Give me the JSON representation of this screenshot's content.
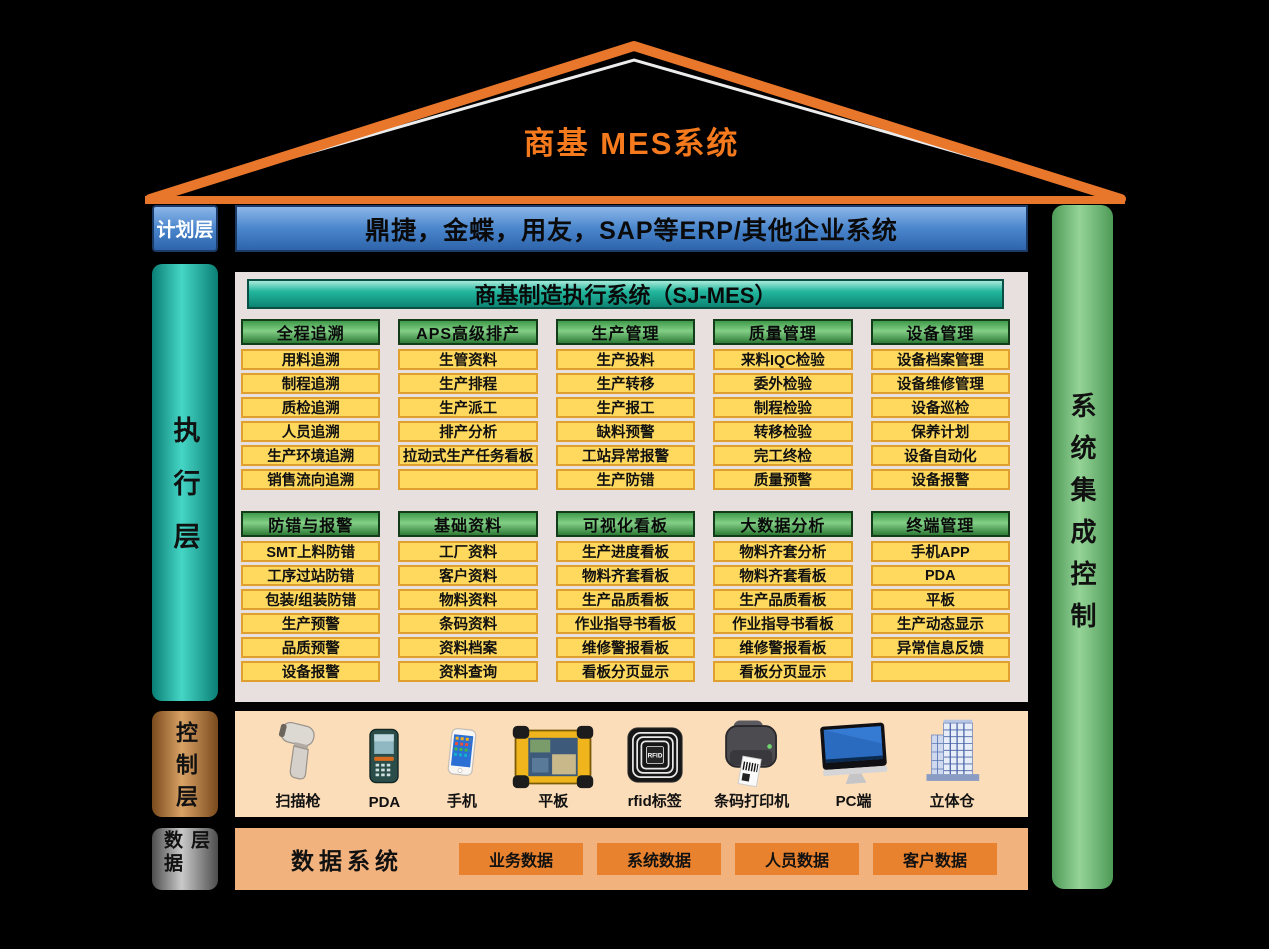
{
  "title": "商基  MES系统",
  "erp_bar": {
    "text": "鼎捷，金蝶，用友，SAP等ERP/其他企业系统"
  },
  "right_bar": {
    "label": "系统集成控制"
  },
  "layers": {
    "plan": {
      "label": "计划层"
    },
    "execute": {
      "label": "执行层"
    },
    "control": {
      "label": "控制层"
    },
    "data": {
      "label": "数据层"
    }
  },
  "mes_panel": {
    "header": "商基制造执行系统（SJ-MES）",
    "row1": [
      {
        "header": "全程追溯",
        "items": [
          "用料追溯",
          "制程追溯",
          "质检追溯",
          "人员追溯",
          "生产环境追溯",
          "销售流向追溯"
        ]
      },
      {
        "header": "APS高级排产",
        "items": [
          "生管资料",
          "生产排程",
          "生产派工",
          "排产分析",
          "拉动式生产任务看板",
          ""
        ]
      },
      {
        "header": "生产管理",
        "items": [
          "生产投料",
          "生产转移",
          "生产报工",
          "缺料预警",
          "工站异常报警",
          "生产防错"
        ]
      },
      {
        "header": "质量管理",
        "items": [
          "来料IQC检验",
          "委外检验",
          "制程检验",
          "转移检验",
          "完工终检",
          "质量预警"
        ]
      },
      {
        "header": "设备管理",
        "items": [
          "设备档案管理",
          "设备维修管理",
          "设备巡检",
          "保养计划",
          "设备自动化",
          "设备报警"
        ]
      }
    ],
    "row2": [
      {
        "header": "防错与报警",
        "items": [
          "SMT上料防错",
          "工序过站防错",
          "包装/组装防错",
          "生产预警",
          "品质预警",
          "设备报警"
        ]
      },
      {
        "header": "基础资料",
        "items": [
          "工厂资料",
          "客户资料",
          "物料资料",
          "条码资料",
          "资料档案",
          "资料查询"
        ]
      },
      {
        "header": "可视化看板",
        "items": [
          "生产进度看板",
          "物料齐套看板",
          "生产品质看板",
          "作业指导书看板",
          "维修警报看板",
          "看板分页显示"
        ]
      },
      {
        "header": "大数据分析",
        "items": [
          "物料齐套分析",
          "物料齐套看板",
          "生产品质看板",
          "作业指导书看板",
          "维修警报看板",
          "看板分页显示"
        ]
      },
      {
        "header": "终端管理",
        "items": [
          "手机APP",
          "PDA",
          "平板",
          "生产动态显示",
          "异常信息反馈",
          ""
        ]
      }
    ]
  },
  "control_row": {
    "devices": [
      {
        "icon": "scanner-icon",
        "label": "扫描枪"
      },
      {
        "icon": "pda-icon",
        "label": "PDA"
      },
      {
        "icon": "phone-icon",
        "label": "手机"
      },
      {
        "icon": "tablet-icon",
        "label": "平板"
      },
      {
        "icon": "rfid-icon",
        "label": "rfid标签"
      },
      {
        "icon": "barcode-printer-icon",
        "label": "条码打印机"
      },
      {
        "icon": "pc-icon",
        "label": "PC端"
      },
      {
        "icon": "warehouse-icon",
        "label": "立体仓"
      }
    ]
  },
  "data_row": {
    "system_label": "数据系统",
    "boxes": [
      "业务数据",
      "系统数据",
      "人员数据",
      "客户数据"
    ]
  },
  "colors": {
    "roof_orange": "#E8762B",
    "title_orange": "#F5791D",
    "erp_blue": "#4A86CC",
    "panel_bg": "#E7E0DE",
    "module_header_green": "#3F9A49",
    "item_yellow": "#FFD95E",
    "item_border": "#DFA02F",
    "exec_teal": "#2BC4B4",
    "side_green": "#6FBA75",
    "control_brown": "#C9924F",
    "data_gray": "#9E9E9E",
    "control_bg": "#FCDDB9",
    "data_bg": "#F2B27D",
    "data_box_orange": "#E8822E"
  }
}
